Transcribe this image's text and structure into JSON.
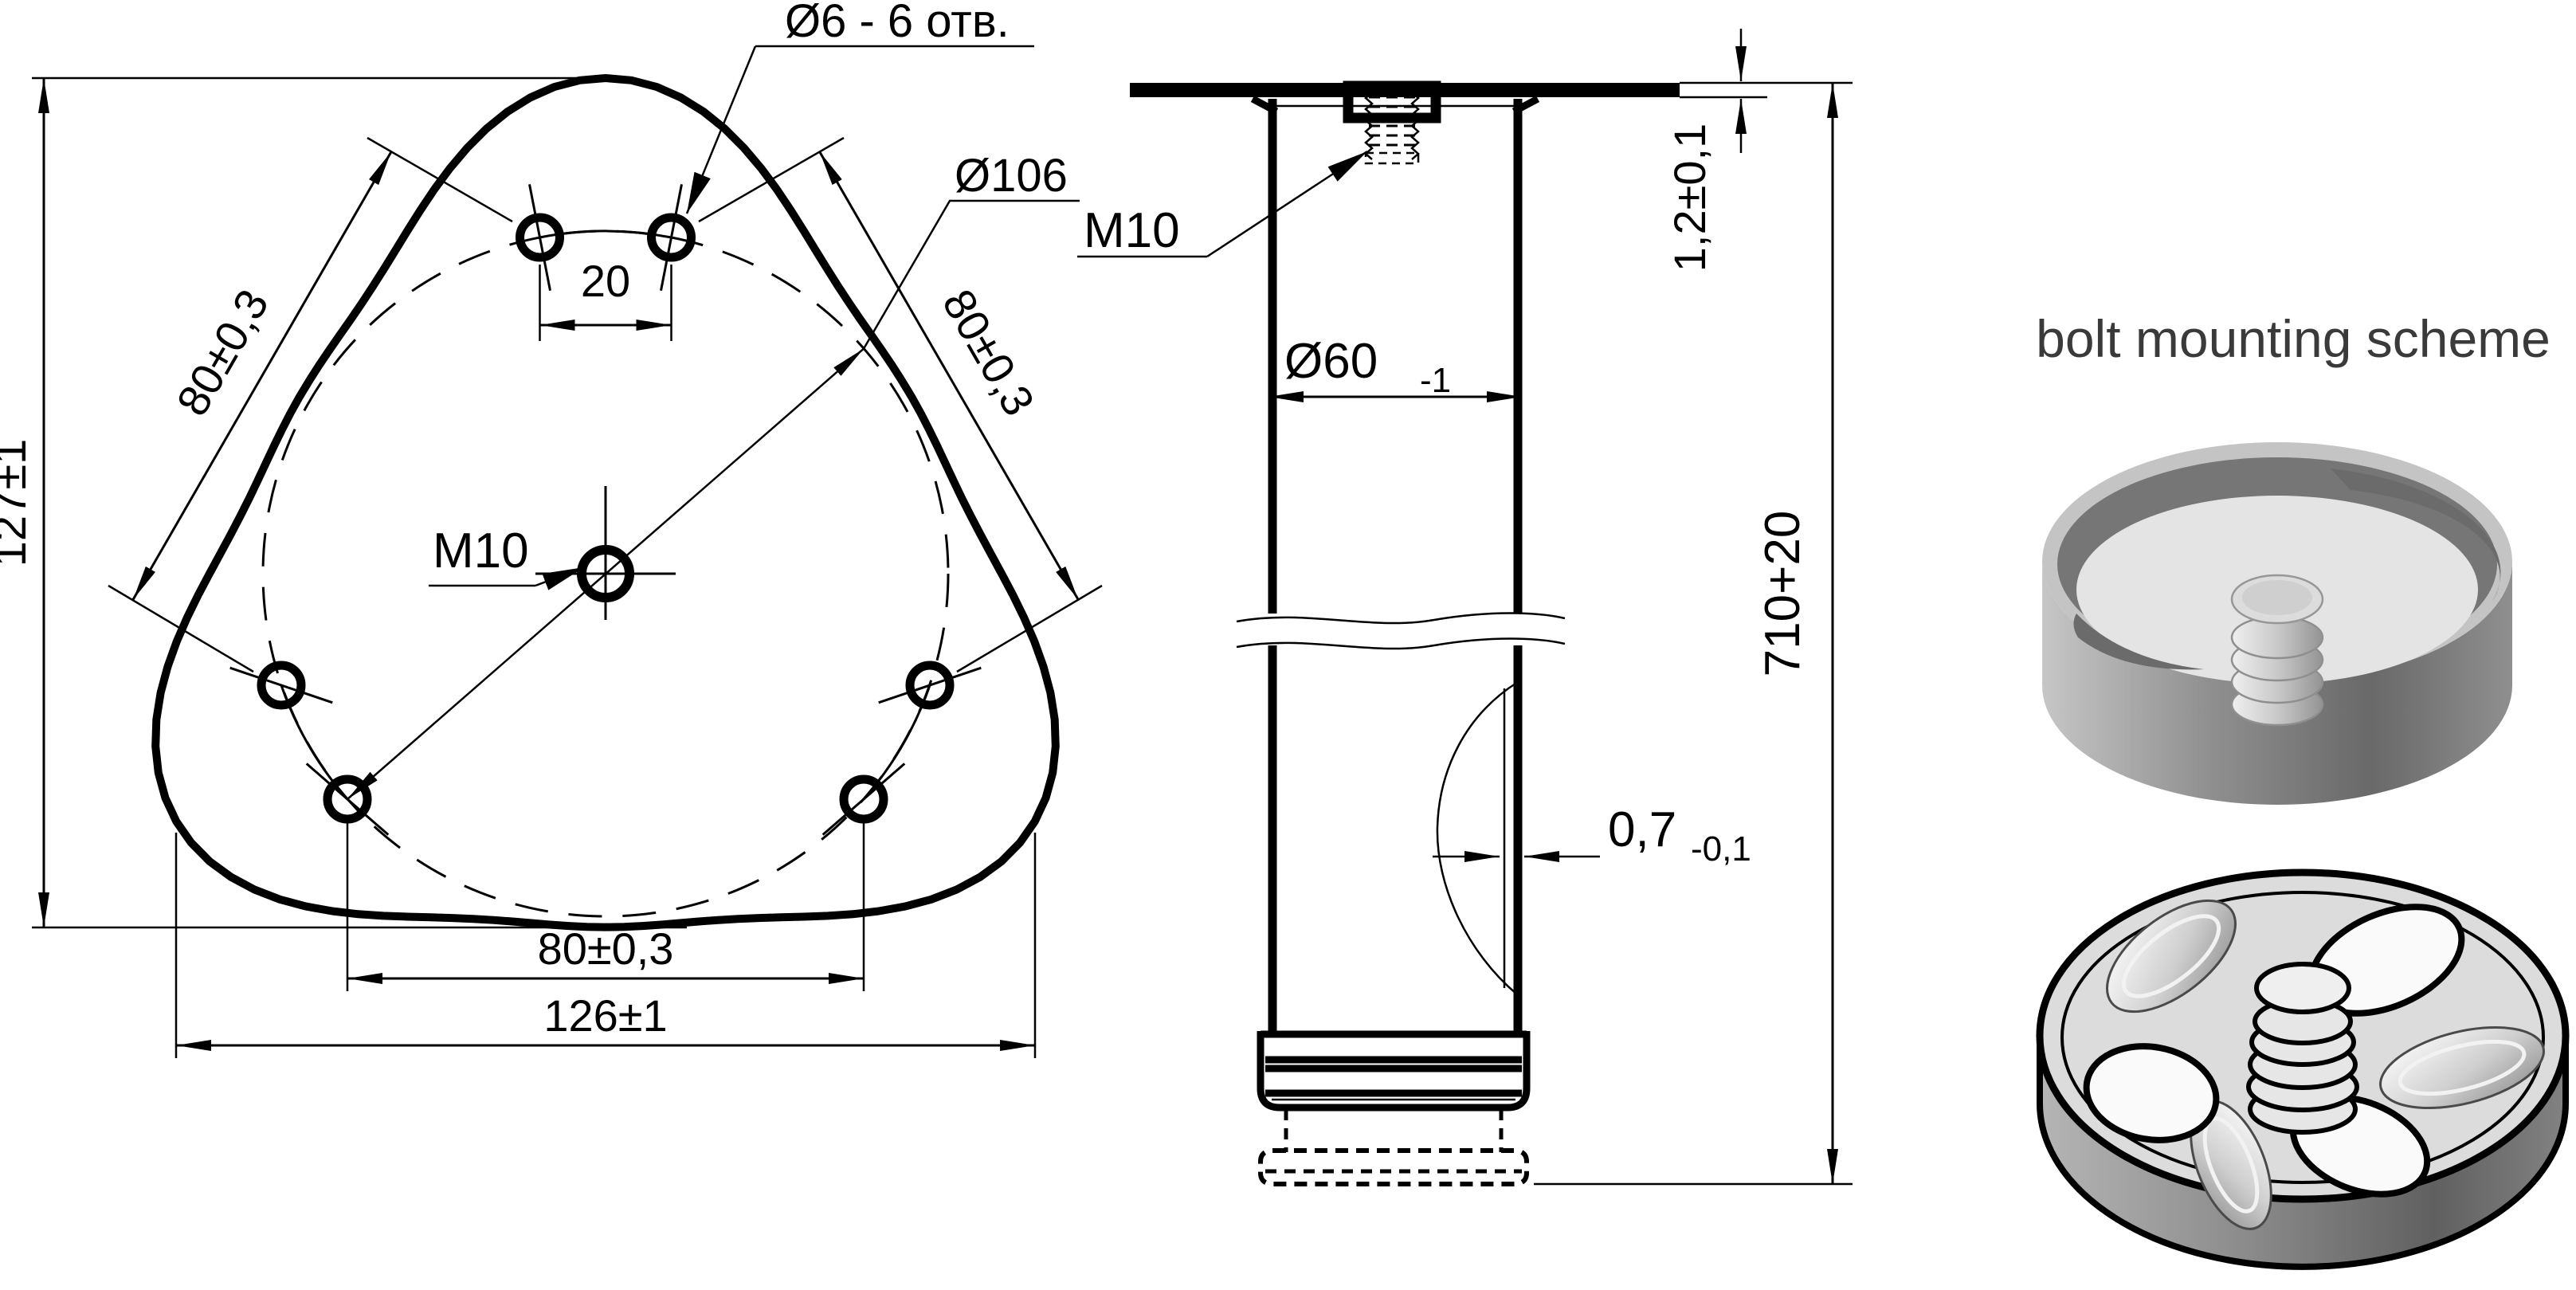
{
  "plan_view": {
    "hole_callout": "Ø6 - 6 отв.",
    "bolt_circle_diameter": "Ø106",
    "center_thread": "M10",
    "pair_spacing": "20",
    "spacing_left": "80±0,3",
    "spacing_right": "80±0,3",
    "spacing_bottom": "80±0,3",
    "overall_height": "127±1",
    "overall_width": "126±1"
  },
  "side_view": {
    "thread_callout": "M10",
    "outer_diameter": "Ø60",
    "outer_diameter_tolerance": "-1",
    "plate_thickness": "1,2±0,1",
    "length": "710+20",
    "wall_thickness": "0,7",
    "wall_thickness_tolerance": "-0,1"
  },
  "scheme": {
    "title": "bolt mounting scheme"
  },
  "colors": {
    "ink": "#000000",
    "title": "#3a3a3a",
    "background": "#ffffff",
    "metal_light": "#e3e3e3",
    "metal_dark": "#6f6f6f"
  }
}
